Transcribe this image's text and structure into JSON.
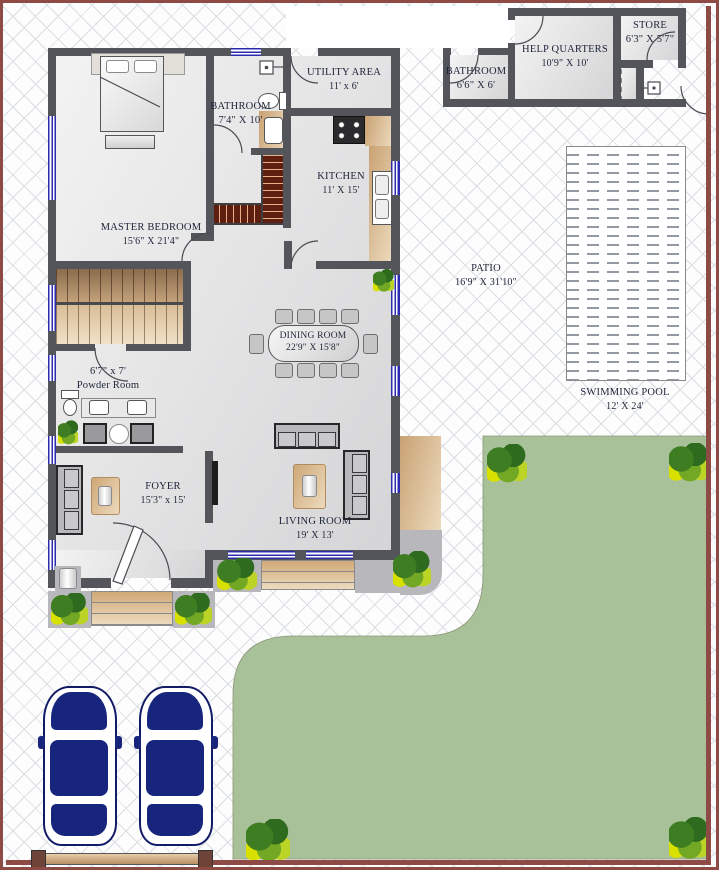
{
  "title": "Residential Floor Plan",
  "rooms": {
    "master_bedroom": {
      "name": "MASTER BEDROOM",
      "dims": "15'6\" X 21'4\""
    },
    "bathroom": {
      "name": "BATHROOM",
      "dims": "7'4\" X 10'"
    },
    "utility": {
      "name": "UTILITY AREA",
      "dims": "11' x 6'"
    },
    "kitchen": {
      "name": "KITCHEN",
      "dims": "11' X 15'"
    },
    "dining": {
      "name": "DINING ROOM",
      "dims": "22'9\" X 15'8\""
    },
    "powder": {
      "name": "Powder Room",
      "dims": "6'7\" x 7'"
    },
    "foyer": {
      "name": "FOYER",
      "dims": "15'3\" x 15'"
    },
    "living": {
      "name": "LIVING ROOM",
      "dims": "19' X 13'"
    },
    "patio": {
      "name": "PATIO",
      "dims": "16'9\" X 31'10\""
    },
    "pool": {
      "name": "SWIMMING POOL",
      "dims": "12' X 24'"
    },
    "help_quarters": {
      "name": "HELP QUARTERS",
      "dims": "10'9\" X 10'"
    },
    "help_bathroom": {
      "name": "BATHROOM",
      "dims": "6'6\" X 6'"
    },
    "store": {
      "name": "STORE",
      "dims": "6'3\" X 5'7\""
    }
  },
  "colors": {
    "wall": "#54555a",
    "compound_wall": "#8e4a44",
    "lawn": "#a9c199",
    "window_blue": "#2b2bb0",
    "stair_wood": "#5e1f10",
    "counter_tan": "#d9bb92",
    "car_blue": "#17267c"
  }
}
